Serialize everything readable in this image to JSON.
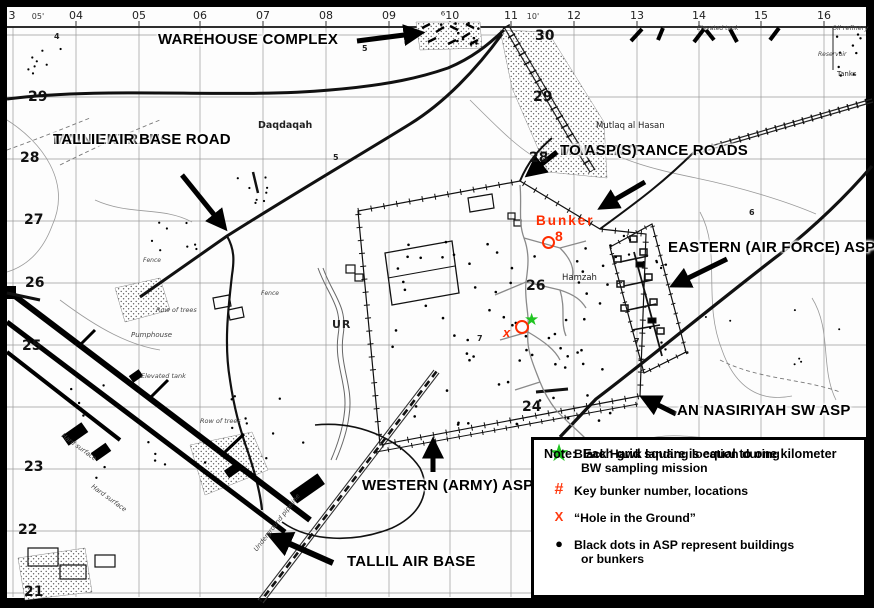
{
  "grid": {
    "top": [
      "3",
      "05'",
      "04",
      "05",
      "06",
      "07",
      "08",
      "09",
      "⁶10",
      "11",
      "10'",
      "12",
      "13",
      "14",
      "15",
      "16"
    ],
    "left": [
      "29",
      "28",
      "27",
      "26",
      "25",
      "23",
      "22",
      "21"
    ],
    "inner": [
      "30",
      "29",
      "28",
      "26",
      "24"
    ]
  },
  "annotations": {
    "warehouse": "WAREHOUSE COMPLEX",
    "entrance_road_line1": "MAIN ENTRANCE ROAD",
    "entrance_road_line2": "TALLIL AIR BASE",
    "entrance_roads_line1": "MAIN ENTRANCE ROADS",
    "entrance_roads_line2": "TO ASP(S)",
    "eastern_asp": "EASTERN (AIR FORCE) ASP",
    "an_nasiriyah": "AN NASIRIYAH SW ASP",
    "western_asp": "WESTERN (ARMY) ASP",
    "tallil": "TALLIL AIR BASE"
  },
  "markers": {
    "bunker_label": "Bunker",
    "bunker_number": "8",
    "hole_x": "x",
    "landing_star": "★",
    "legend_star": "★",
    "legend_hash": "#",
    "legend_x": "X",
    "legend_dot": "●"
  },
  "place_names": {
    "daqdaqah": "Daqdaqah",
    "mutlaq": "Mutlaq al Hasan",
    "hamzah": "Hamzah",
    "ur": "UR",
    "pumphouse": "Pumphouse",
    "row_of_trees1": "Row of trees",
    "row_of_trees2": "Row of trees",
    "elevated_tank1": "Elevated tank",
    "elevated_tank2": "Elevated tank",
    "fence1": "Fence",
    "fence2": "Fence",
    "hard_surface1": "Hard surface",
    "hard_surface2": "Hard surface",
    "underground_pipeline": "Underground pipeline",
    "oil_refinery": "Oil refinery",
    "reservoir": "Reservoir",
    "tanks": "Tanks"
  },
  "spots": [
    "4",
    "5",
    "5",
    "6",
    "7",
    "7"
  ],
  "legend": {
    "note_label": "Note:",
    "note_text": "Each grid square is equal to one kilometer",
    "items": [
      {
        "line1": "Black Hawk landing location during",
        "line2": "BW sampling mission"
      },
      {
        "line1": "Key bunker number, locations",
        "line2": ""
      },
      {
        "line1": "“Hole in the Ground”",
        "line2": ""
      },
      {
        "line1": "Black dots in ASP represent buildings",
        "line2": "or bunkers"
      }
    ]
  },
  "colors": {
    "star_green": "#1fc420",
    "legend_symbol_red": "#ff3a10",
    "bunker_red": "#ff2d00",
    "map_ink": "#000000"
  }
}
